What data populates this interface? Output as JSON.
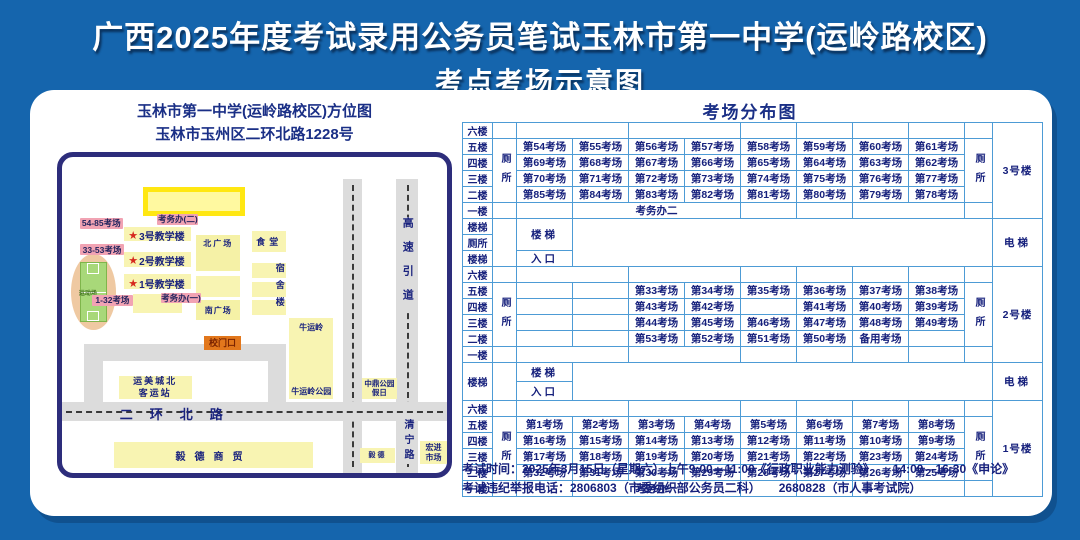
{
  "header": {
    "line1": "广西2025年度考试录用公务员笔试玉林市第一中学(运岭路校区)",
    "line2": "考点考场示意图"
  },
  "map": {
    "title_line1": "玉林市第一中学(运岭路校区)方位图",
    "title_line2": "玉林市玉州区二环北路1228号",
    "labels": {
      "admin_office_2": "考务办(二)",
      "admin_office_1": "考务办(一)",
      "rooms_54_85": "54-85考场",
      "rooms_33_53": "33-53考场",
      "rooms_1_32": "1-32考场",
      "building3": "3号教学楼",
      "building2": "2号教学楼",
      "building1": "1号教学楼",
      "star": "★",
      "north_plaza": "北广场",
      "south_plaza": "南广场",
      "canteen": "食堂",
      "dormitory": "宿舍楼",
      "sports_field": "运动场",
      "school_gate": "校门口",
      "bus_station_l1": "运美城北",
      "bus_station_l2": "客运站",
      "niuyunling": "牛运岭",
      "niuyunling_park": "牛运岭公园",
      "zhongding_l1": "中鼎公园",
      "zhongding_l2": "假日",
      "erhuan_road": "二环北路",
      "yide_trade": "毅德商贸",
      "yide": "毅德",
      "qingning_road": "清宁路",
      "hongjin_l1": "宏进",
      "hongjin_l2": "市场",
      "expressway": "高速引道"
    }
  },
  "distribution": {
    "title": "考场分布图",
    "toilet": "厕所",
    "blocks": [
      {
        "building": "3号楼",
        "rows": [
          {
            "floor": "六楼",
            "cells": [
              {
                "t": "",
                "s": 2
              },
              {
                "t": "",
                "s": 2
              },
              {
                "t": ""
              },
              {
                "t": ""
              },
              {
                "t": ""
              },
              {
                "t": ""
              }
            ]
          },
          {
            "floor": "五楼",
            "cells": [
              {
                "t": "第54考场"
              },
              {
                "t": "第55考场"
              },
              {
                "t": "第56考场"
              },
              {
                "t": "第57考场"
              },
              {
                "t": "第58考场"
              },
              {
                "t": "第59考场"
              },
              {
                "t": "第60考场"
              },
              {
                "t": "第61考场"
              }
            ]
          },
          {
            "floor": "四楼",
            "cells": [
              {
                "t": "第69考场"
              },
              {
                "t": "第68考场"
              },
              {
                "t": "第67考场"
              },
              {
                "t": "第66考场"
              },
              {
                "t": "第65考场"
              },
              {
                "t": "第64考场"
              },
              {
                "t": "第63考场"
              },
              {
                "t": "第62考场"
              }
            ]
          },
          {
            "floor": "三楼",
            "cells": [
              {
                "t": "第70考场"
              },
              {
                "t": "第71考场"
              },
              {
                "t": "第72考场"
              },
              {
                "t": "第73考场"
              },
              {
                "t": "第74考场"
              },
              {
                "t": "第75考场"
              },
              {
                "t": "第76考场"
              },
              {
                "t": "第77考场"
              }
            ]
          },
          {
            "floor": "二楼",
            "cells": [
              {
                "t": "第85考场"
              },
              {
                "t": "第84考场"
              },
              {
                "t": "第83考场"
              },
              {
                "t": "第82考场"
              },
              {
                "t": "第81考场"
              },
              {
                "t": "第80考场"
              },
              {
                "t": "第79考场"
              },
              {
                "t": "第78考场"
              }
            ]
          },
          {
            "floor": "一楼",
            "cells": [
              {
                "t": ""
              },
              {
                "t": "考务办二",
                "s": 3
              },
              {
                "t": ""
              },
              {
                "t": ""
              },
              {
                "t": "",
                "s": 2
              }
            ]
          }
        ]
      },
      {
        "building": "2号楼",
        "rows": [
          {
            "floor": "六楼",
            "cells": [
              {
                "t": "",
                "s": 2
              },
              {
                "t": "",
                "s": 2
              },
              {
                "t": ""
              },
              {
                "t": ""
              },
              {
                "t": ""
              },
              {
                "t": ""
              }
            ]
          },
          {
            "floor": "五楼",
            "cells": [
              {
                "t": ""
              },
              {
                "t": ""
              },
              {
                "t": "第33考场"
              },
              {
                "t": "第34考场"
              },
              {
                "t": "第35考场"
              },
              {
                "t": "第36考场"
              },
              {
                "t": "第37考场"
              },
              {
                "t": "第38考场"
              }
            ]
          },
          {
            "floor": "四楼",
            "cells": [
              {
                "t": ""
              },
              {
                "t": ""
              },
              {
                "t": "第43考场"
              },
              {
                "t": "第42考场"
              },
              {
                "t": ""
              },
              {
                "t": "第41考场"
              },
              {
                "t": "第40考场"
              },
              {
                "t": "第39考场"
              }
            ]
          },
          {
            "floor": "三楼",
            "cells": [
              {
                "t": ""
              },
              {
                "t": ""
              },
              {
                "t": "第44考场"
              },
              {
                "t": "第45考场"
              },
              {
                "t": "第46考场"
              },
              {
                "t": "第47考场"
              },
              {
                "t": "第48考场"
              },
              {
                "t": "第49考场"
              }
            ]
          },
          {
            "floor": "二楼",
            "cells": [
              {
                "t": ""
              },
              {
                "t": ""
              },
              {
                "t": "第53考场"
              },
              {
                "t": "第52考场"
              },
              {
                "t": "第51考场"
              },
              {
                "t": "第50考场"
              },
              {
                "t": "备用考场"
              },
              {
                "t": ""
              }
            ]
          },
          {
            "floor": "一楼",
            "cells": [
              {
                "t": "",
                "s": 2
              },
              {
                "t": "",
                "s": 2
              },
              {
                "t": ""
              },
              {
                "t": ""
              },
              {
                "t": ""
              },
              {
                "t": ""
              }
            ]
          }
        ]
      },
      {
        "building": "1号楼",
        "rows": [
          {
            "floor": "六楼",
            "cells": [
              {
                "t": "",
                "s": 2
              },
              {
                "t": "",
                "s": 2
              },
              {
                "t": ""
              },
              {
                "t": ""
              },
              {
                "t": ""
              },
              {
                "t": ""
              }
            ]
          },
          {
            "floor": "五楼",
            "cells": [
              {
                "t": "第1考场"
              },
              {
                "t": "第2考场"
              },
              {
                "t": "第3考场"
              },
              {
                "t": "第4考场"
              },
              {
                "t": "第5考场"
              },
              {
                "t": "第6考场"
              },
              {
                "t": "第7考场"
              },
              {
                "t": "第8考场"
              }
            ]
          },
          {
            "floor": "四楼",
            "cells": [
              {
                "t": "第16考场"
              },
              {
                "t": "第15考场"
              },
              {
                "t": "第14考场"
              },
              {
                "t": "第13考场"
              },
              {
                "t": "第12考场"
              },
              {
                "t": "第11考场"
              },
              {
                "t": "第10考场"
              },
              {
                "t": "第9考场"
              }
            ]
          },
          {
            "floor": "三楼",
            "cells": [
              {
                "t": "第17考场"
              },
              {
                "t": "第18考场"
              },
              {
                "t": "第19考场"
              },
              {
                "t": "第20考场"
              },
              {
                "t": "第21考场"
              },
              {
                "t": "第22考场"
              },
              {
                "t": "第23考场"
              },
              {
                "t": "第24考场"
              }
            ]
          },
          {
            "floor": "二楼",
            "cells": [
              {
                "t": "第32考场"
              },
              {
                "t": "第31考场"
              },
              {
                "t": "第30考场"
              },
              {
                "t": "第29考场"
              },
              {
                "t": "第28考场"
              },
              {
                "t": "第27考场"
              },
              {
                "t": "第26考场"
              },
              {
                "t": "第25考场"
              }
            ]
          },
          {
            "floor": "一楼",
            "cells": [
              {
                "t": ""
              },
              {
                "t": "考务办一",
                "s": 3
              },
              {
                "t": ""
              },
              {
                "t": ""
              },
              {
                "t": "",
                "s": 2
              }
            ]
          }
        ]
      }
    ],
    "sections": [
      {
        "left": [
          "楼梯",
          "厕所",
          "楼梯"
        ],
        "stair": "楼梯",
        "entry": "入口",
        "elevator": "电梯"
      },
      {
        "left": [
          "楼梯"
        ],
        "stair": "楼梯",
        "entry": "入口",
        "elevator": "电梯"
      }
    ]
  },
  "footer": {
    "line1": "考试时间：2025年3月15日（星期六）上午9:00—11:00《行政职业能力测验》　　14:00—16:30《申论》",
    "line2": "考试违纪举报电话：2806803（市委组织部公务员二科）　　2680828（市人事考试院）"
  }
}
